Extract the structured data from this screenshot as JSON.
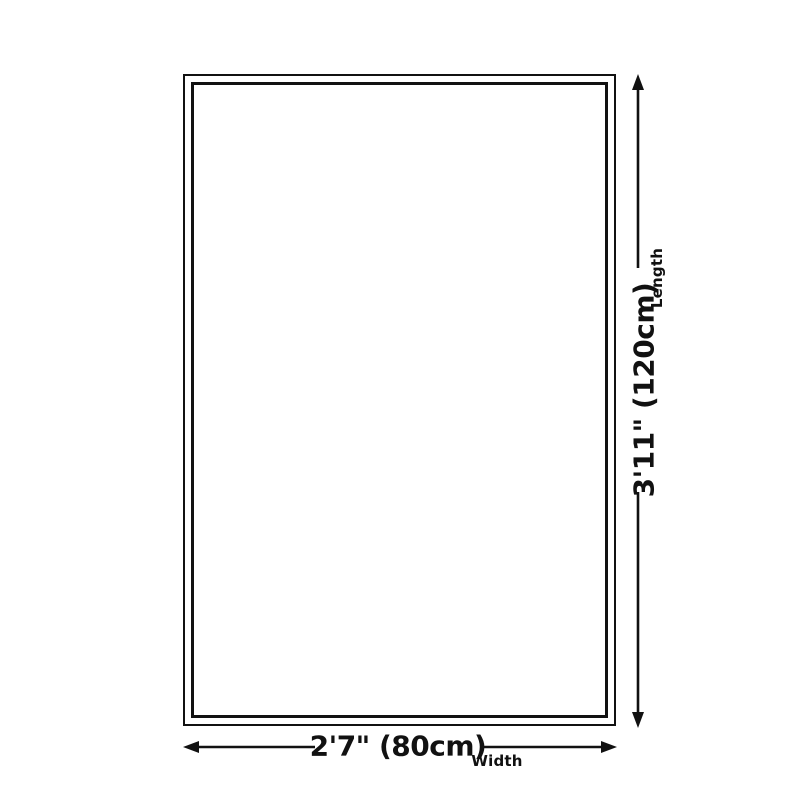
{
  "diagram": {
    "kind": "product-dimension-diagram",
    "shape": "rectangle-double-border",
    "background_color": "#ffffff",
    "line_color": "#111111",
    "length": {
      "value": "3'11\" (120cm)",
      "label": "Length"
    },
    "width": {
      "value": "2'7\" (80cm)",
      "label": "Width"
    }
  }
}
